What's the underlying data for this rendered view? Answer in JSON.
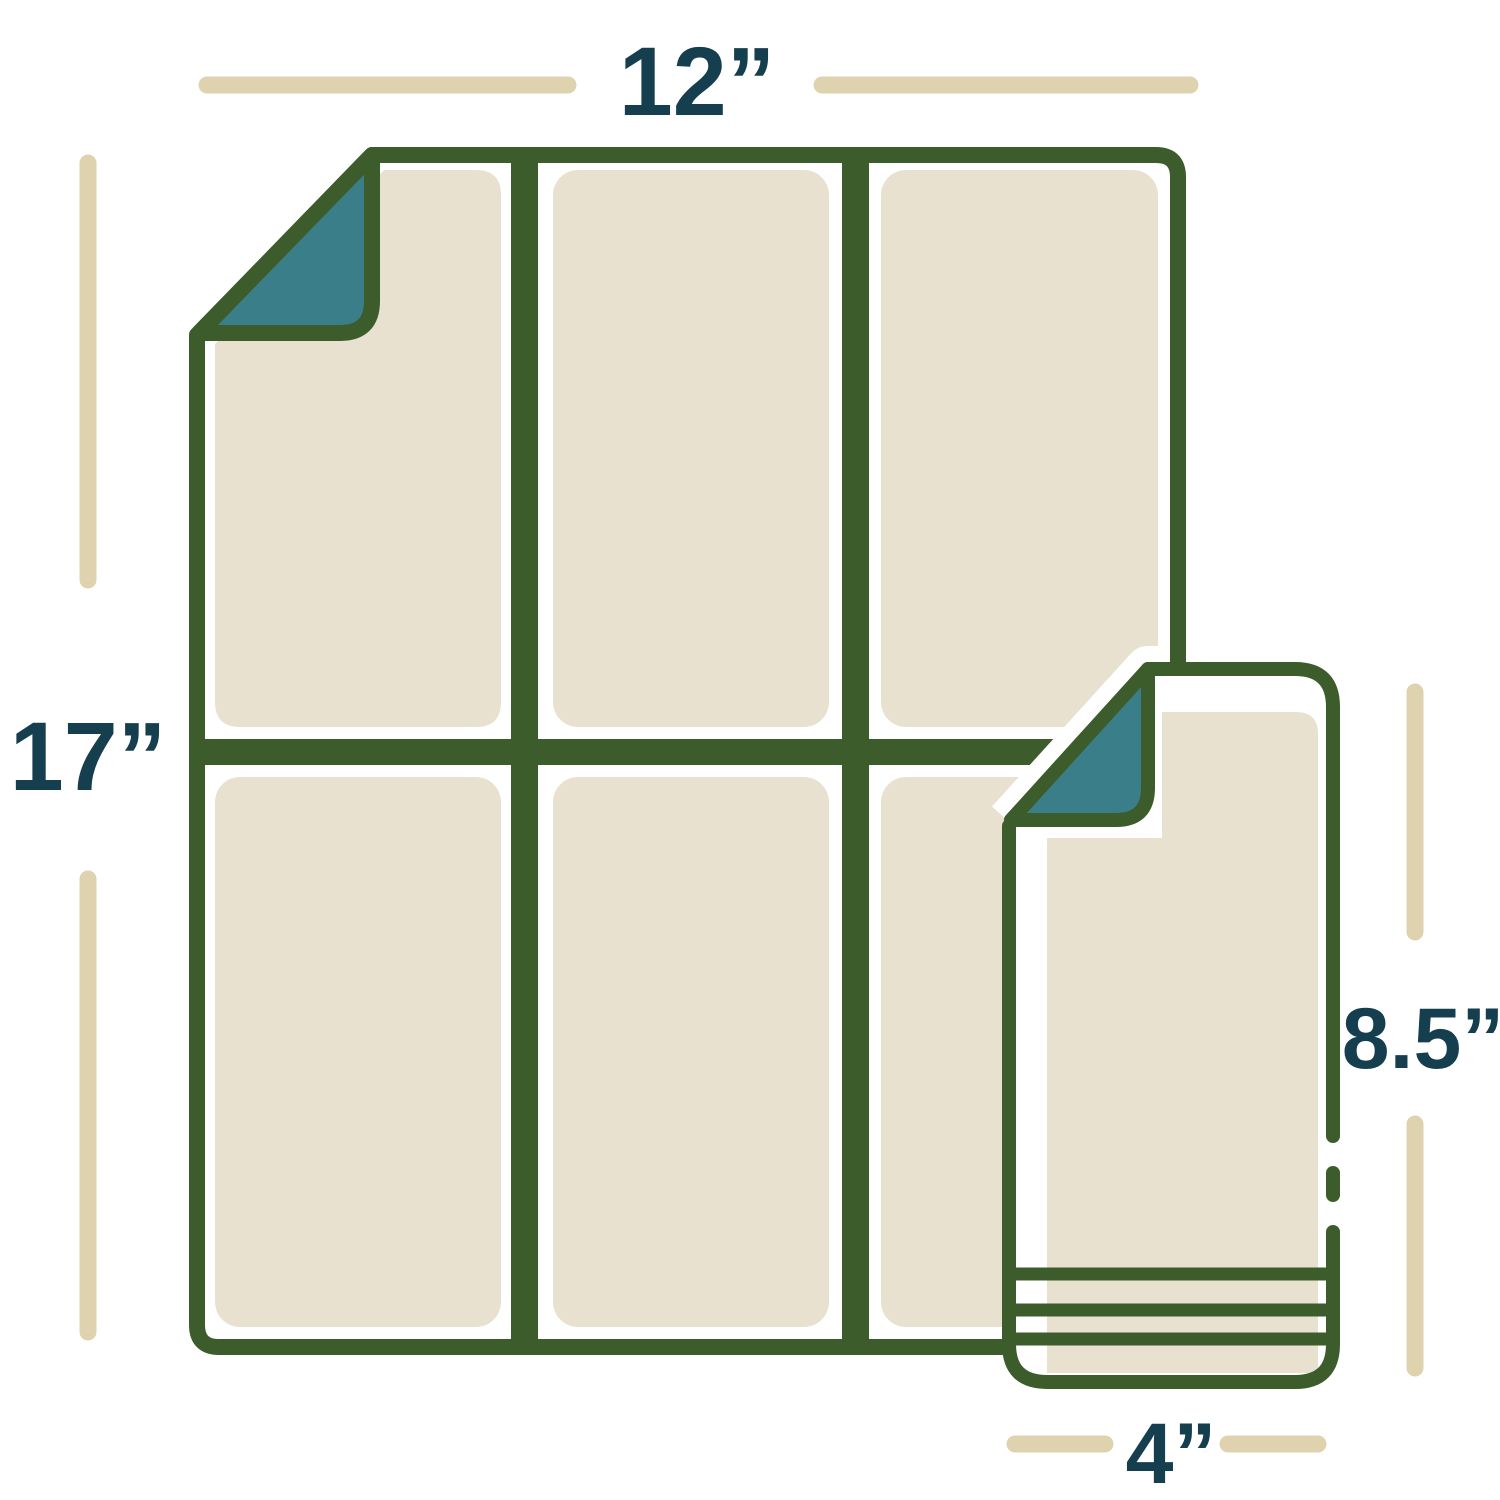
{
  "diagram": {
    "description": "Sheet size diagram: large 12 by 17 inch sheet divided into six panels, with one 4 by 8.5 inch panel shown separately",
    "dimensions": {
      "large_sheet_width": "12”",
      "large_sheet_height": "17”",
      "small_sheet_height": "8.5”",
      "small_sheet_width": "4”"
    },
    "large_sheet": {
      "rows": 2,
      "columns": 3,
      "panel_count": 6,
      "folded_corner": "top-left"
    },
    "small_sheet": {
      "folded_corner": "top-left",
      "bottom_stripe_count": 3
    },
    "colors": {
      "outline_green": "#3D5C2B",
      "panel_cream": "#E9E1CF",
      "fold_teal": "#3A7E8A",
      "label_navy": "#153E4E",
      "dimension_tan": "#DED3AE",
      "background": "#FFFFFF"
    }
  }
}
